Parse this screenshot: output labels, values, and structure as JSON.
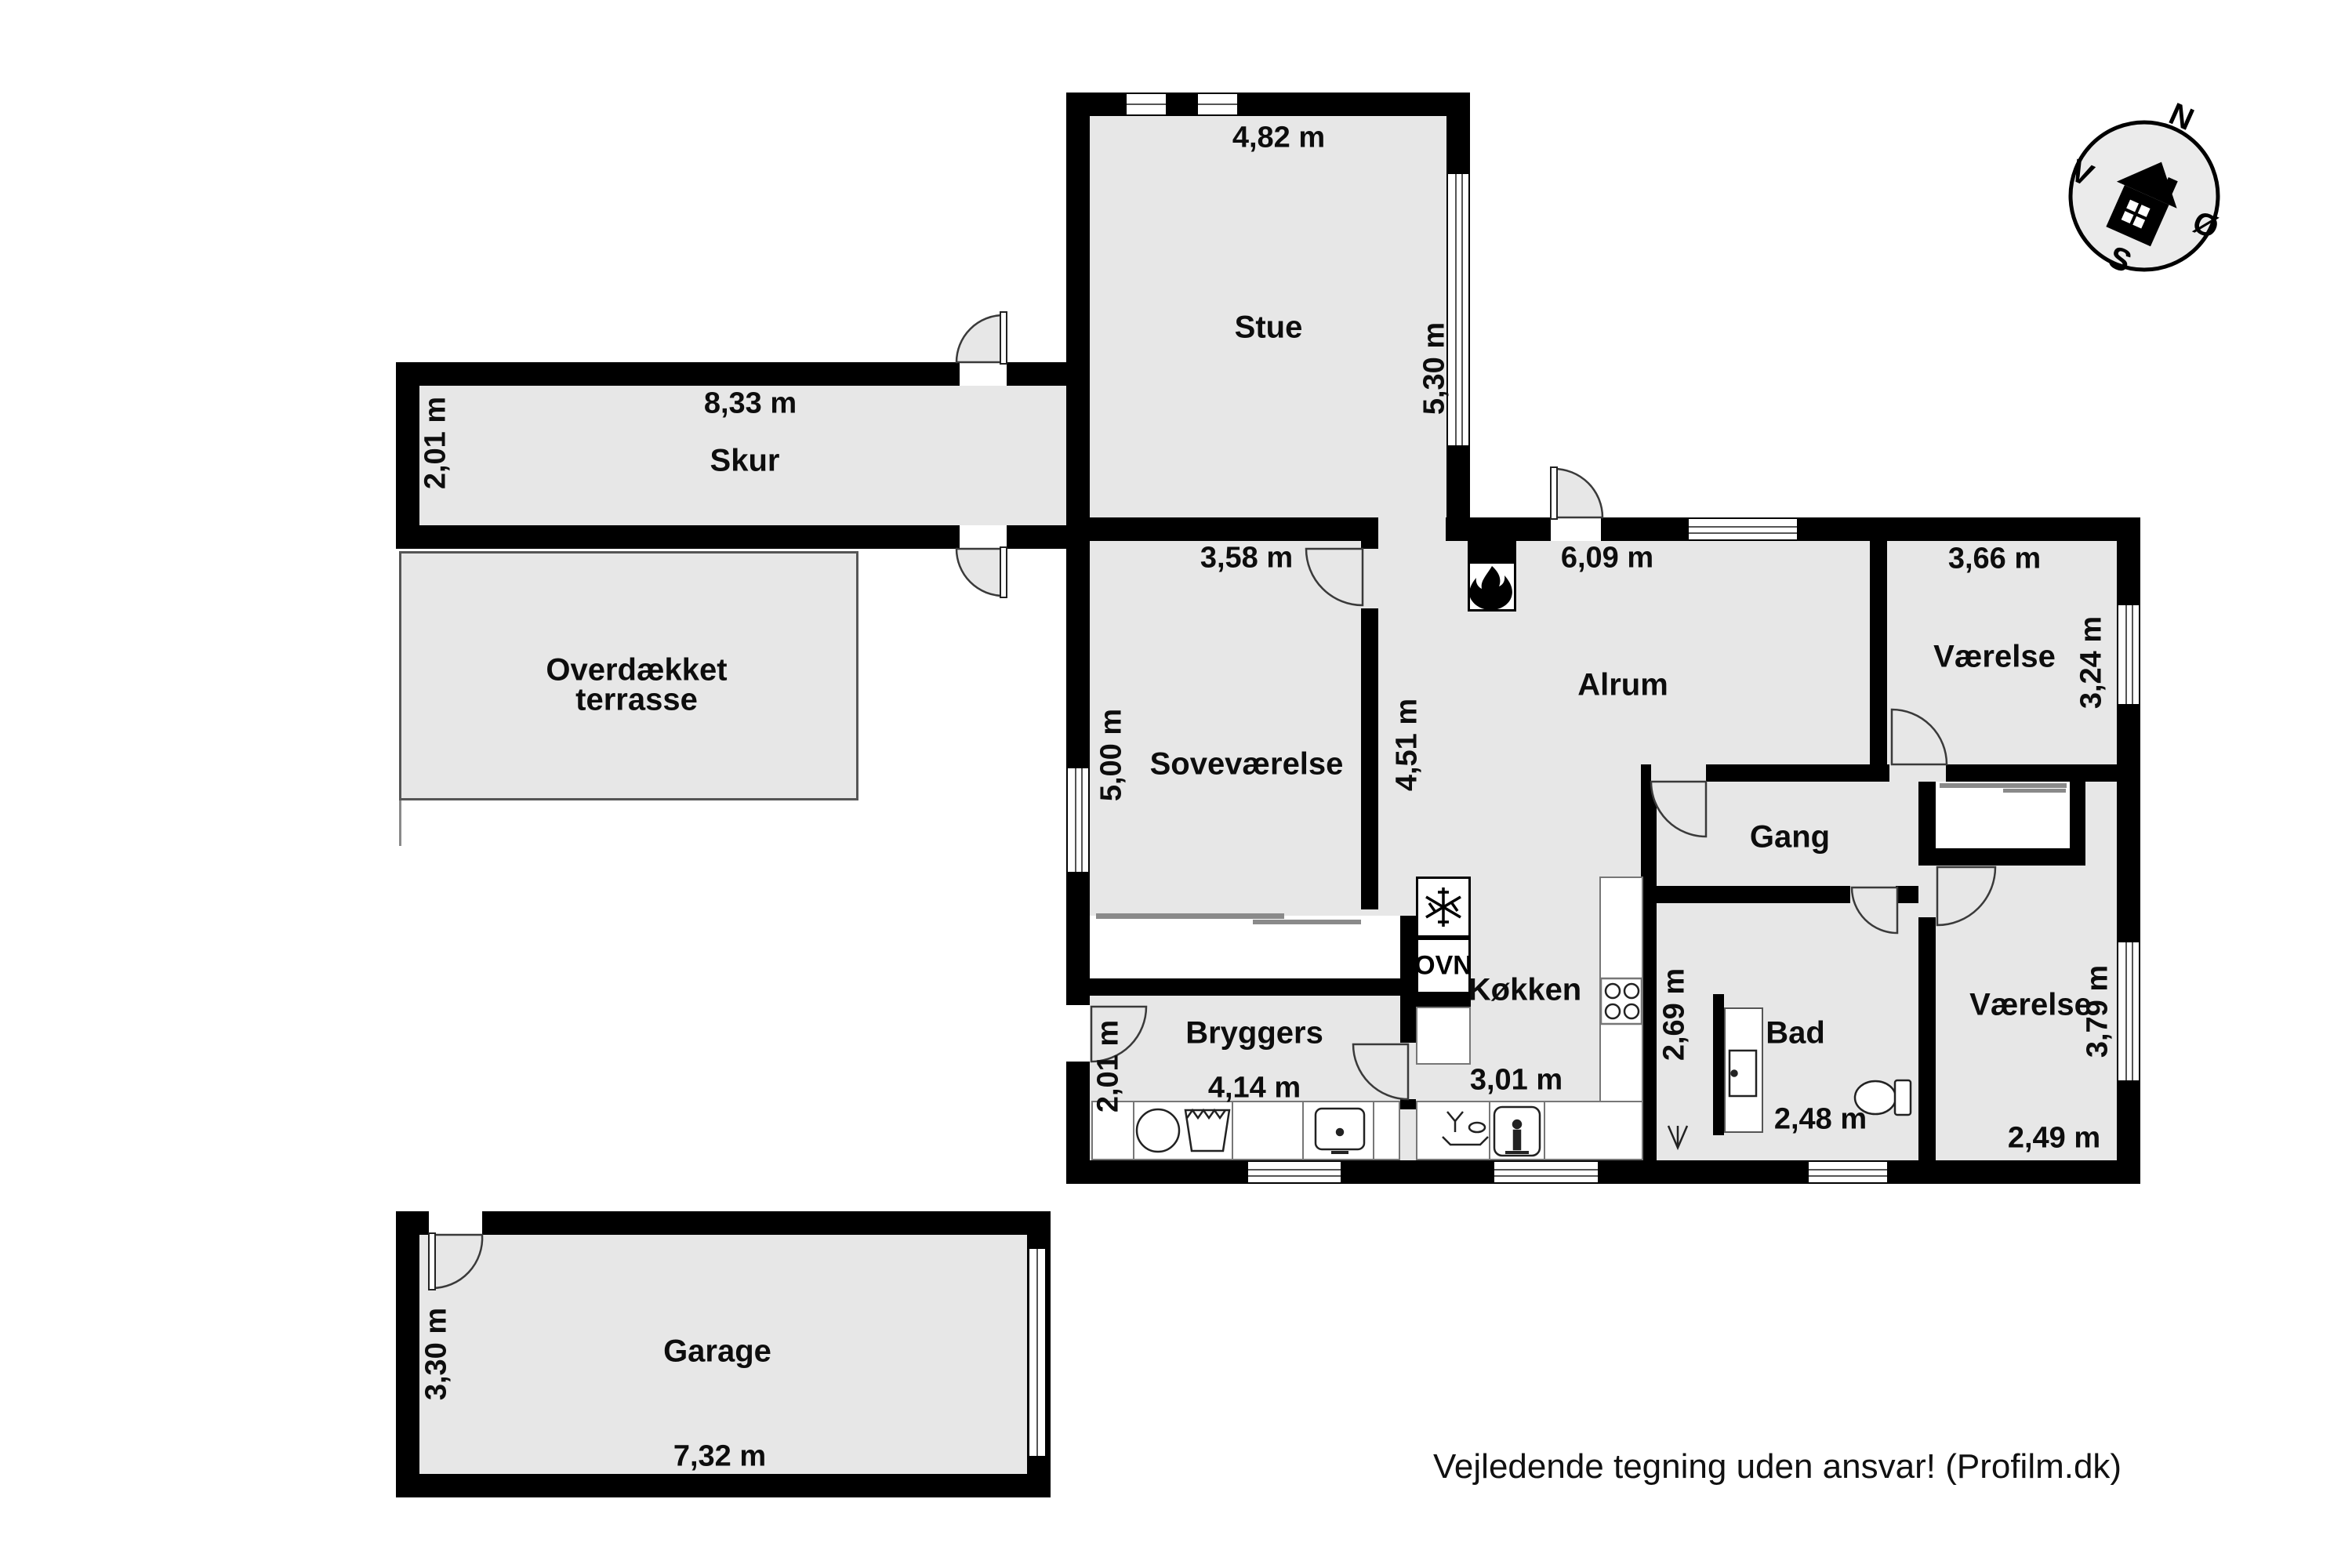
{
  "meta": {
    "footer": "Vejledende tegning uden ansvar! (Profilm.dk)"
  },
  "colors": {
    "wall": "#000000",
    "room_fill": "#e7e7e7",
    "background": "#ffffff",
    "outline": "#555555"
  },
  "compass": {
    "n": "N",
    "e": "Ø",
    "s": "S",
    "w": "V"
  },
  "rooms": {
    "stue": {
      "label": "Stue",
      "width": "4,82 m",
      "height": "5,30 m"
    },
    "skur": {
      "label": "Skur",
      "width": "8,33 m",
      "height": "2,01 m"
    },
    "terrasse": {
      "label_line1": "Overdækket",
      "label_line2": "terrasse"
    },
    "sovevaerelse": {
      "label": "Soveværelse",
      "width": "3,58 m",
      "height": "5,00 m"
    },
    "alrum": {
      "label": "Alrum",
      "width": "6,09 m",
      "height": "4,51 m"
    },
    "vaerelse_ne": {
      "label": "Værelse",
      "width": "3,66 m",
      "height": "3,24 m"
    },
    "gang": {
      "label": "Gang"
    },
    "koekken": {
      "label": "Køkken",
      "width": "3,01 m",
      "height": "2,69 m",
      "oven_label": "OVN"
    },
    "bryggers": {
      "label": "Bryggers",
      "width": "4,14 m",
      "height": "2,01 m"
    },
    "bad": {
      "label": "Bad",
      "width": "2,48 m"
    },
    "vaerelse_se": {
      "label": "Værelse",
      "width": "2,49 m",
      "height": "3,79 m"
    },
    "garage": {
      "label": "Garage",
      "width": "7,32 m",
      "height": "3,30 m"
    }
  }
}
